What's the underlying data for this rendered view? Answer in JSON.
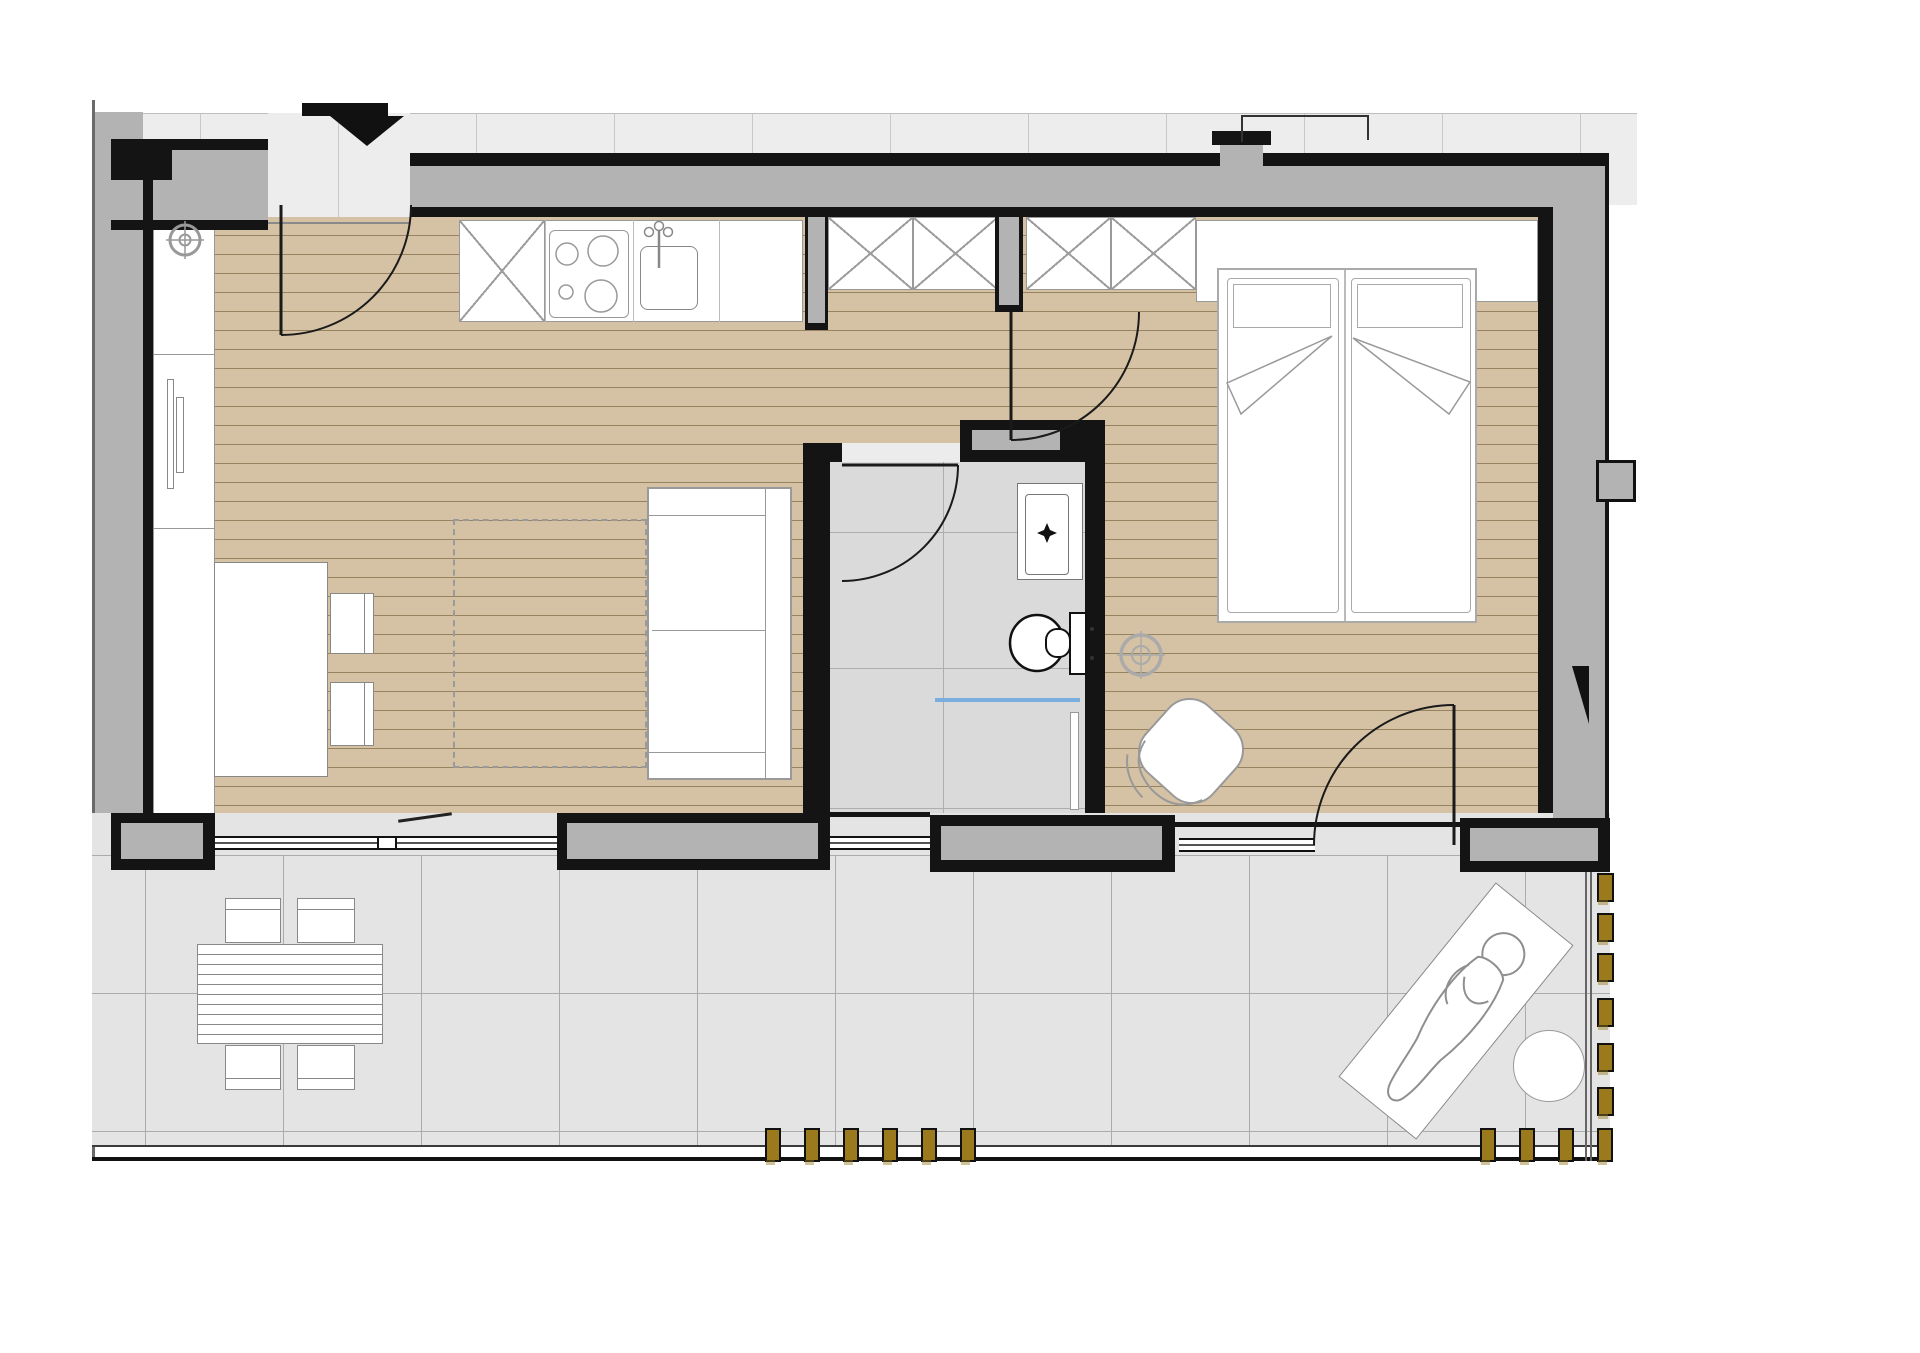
{
  "document": {
    "kind": "architectural-floor-plan",
    "visible_text": [],
    "description_icons": [
      "entrance-arrow-icon",
      "door-swing-icon",
      "window-threshold-icon",
      "ceiling-light-symbol-icon",
      "connection-point-symbol-icon"
    ]
  },
  "colors": {
    "wall_black": "#141414",
    "wall_gray": "#b3b3b3",
    "wood_floor": "#d5c2a4",
    "wood_line": "#97835f",
    "exterior_tile": "#ededed",
    "exterior_tile_line": "#c9c9c9",
    "terrace_tile": "#e4e4e4",
    "terrace_line": "#ababab",
    "bathroom_tile": "#dadada",
    "furniture_stroke": "#999999",
    "fence_post": "#9a7a1c",
    "shower_screen_blue": "#7aaede"
  },
  "rooms": [
    {
      "id": "living-kitchen",
      "floor": "wood",
      "items": [
        "kitchen-counter",
        "x-cabinet",
        "stove",
        "kitchen-sink",
        "dining-table",
        "chair",
        "chair",
        "sofa",
        "rug",
        "wall-unit",
        "radiator",
        "entrance-door"
      ]
    },
    {
      "id": "hallway",
      "floor": "wood",
      "items": [
        "tall-cabinet",
        "tall-cabinet",
        "interior-door"
      ]
    },
    {
      "id": "bathroom",
      "floor": "tile",
      "items": [
        "washbasin",
        "toilet",
        "shower-screen",
        "glass-panel",
        "bathroom-door",
        "bathroom-window"
      ]
    },
    {
      "id": "bedroom",
      "floor": "wood",
      "items": [
        "wardrobe",
        "wardrobe",
        "shelf-unit",
        "double-bed",
        "armchair",
        "terrace-door",
        "bedroom-window",
        "ceiling-light-symbol"
      ]
    },
    {
      "id": "terrace",
      "floor": "tile",
      "items": [
        "outdoor-table",
        "outdoor-chair",
        "outdoor-chair",
        "outdoor-chair",
        "outdoor-chair",
        "sun-lounger",
        "person-on-lounger",
        "side-table",
        "fence"
      ]
    }
  ],
  "exterior_strip": {
    "line_xs": [
      200,
      338,
      476,
      614,
      752,
      890,
      1028,
      1166,
      1304,
      1442,
      1580
    ]
  },
  "terrace": {
    "grid_xs": [
      145,
      283,
      421,
      559,
      697,
      835,
      973,
      1111,
      1249,
      1387,
      1525
    ],
    "grid_ys": [
      855,
      993,
      1131
    ],
    "fence": {
      "bottom_posts_a_x": [
        765,
        804,
        843,
        882,
        921,
        960
      ],
      "bottom_posts_b_x": [
        1480,
        1519,
        1558,
        1597
      ],
      "bottom_posts_y": 1128,
      "bottom_post_w": 12,
      "bottom_post_h": 30,
      "right_posts_y": [
        873,
        913,
        953,
        998,
        1043,
        1087
      ],
      "right_posts_x": 1597,
      "right_post_w": 13,
      "right_post_h": 25
    }
  },
  "bed": {
    "mattresses": 2,
    "pillows": 2,
    "blankets": 2
  },
  "seating": {
    "indoor_chairs": 2,
    "outdoor_chairs": 4
  }
}
